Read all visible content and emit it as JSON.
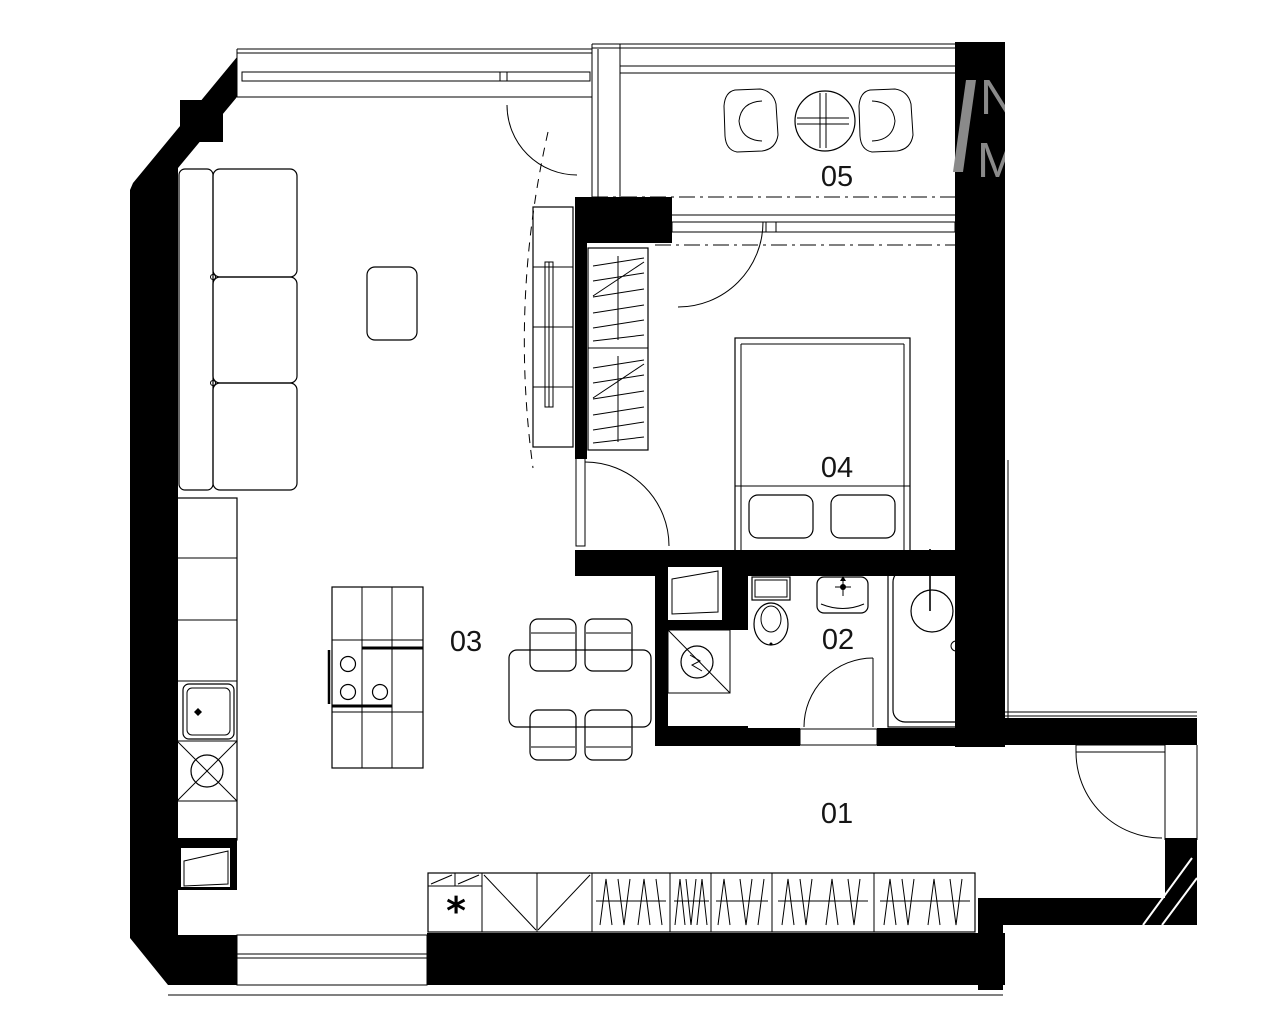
{
  "rooms": {
    "r01": {
      "label": "01"
    },
    "r02": {
      "label": "02"
    },
    "r03": {
      "label": "03"
    },
    "r04": {
      "label": "04"
    },
    "r05": {
      "label": "05"
    }
  },
  "symbols": {
    "closet_asterisk": "*"
  },
  "watermark": {
    "top_letter": "N",
    "bottom_letter": "M",
    "color": "#8a8a8a"
  },
  "colors": {
    "walls": "#000000",
    "lines": "#000000",
    "background": "#ffffff"
  }
}
